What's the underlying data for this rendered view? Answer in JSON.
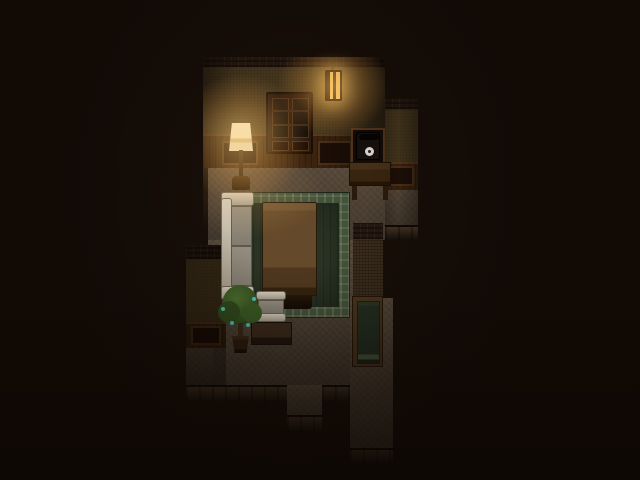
{
  "meta": {
    "type": "game-screenshot",
    "style": "top-down pixel RPG interior at night",
    "viewport": {
      "width": 640,
      "height": 480
    }
  },
  "scene": {
    "description": "Dark wooden apartment seen from above: upper room with a lit hanging wall lantern, glass-front cabinet, lit floor lamp and a telephone shelf above a small table; living area with a green patterned rug, a large wooden table, a pale sofa and armchair, a low dark table and a potted plant with teal blossoms; floor exits lead downward and a tall green-paneled door stands in the right-hand corridor",
    "objects": {
      "lantern": {
        "label": "Lit hanging wall lantern"
      },
      "cabinet": {
        "label": "Glass-front wooden cabinet"
      },
      "lamp": {
        "label": "Lit floor lamp"
      },
      "telephone": {
        "label": "Old telephone on wall shelf"
      },
      "phoneTable": {
        "label": "Small wooden side table"
      },
      "rug": {
        "label": "Green patterned rug"
      },
      "table": {
        "label": "Large wooden table"
      },
      "sofa": {
        "label": "Pale upholstered sofa"
      },
      "armchair": {
        "label": "Pale upholstered armchair"
      },
      "lowTable": {
        "label": "Low dark table"
      },
      "plant": {
        "label": "Potted plant with teal blossoms"
      },
      "door": {
        "label": "Tall green-paneled door"
      }
    }
  },
  "colors": {
    "outside": "#170e08",
    "wall-cap": "#251810",
    "wall-face": "#47381f",
    "wainscot": "#3a2410",
    "wainscot-frame": "#503218",
    "panel-dark": "#1e0f07",
    "floor": "#55483a",
    "cliff": "#2f2217",
    "rug-border": "#44513b",
    "rug-field": "#2b3525",
    "table-top": "#64492a",
    "sofa-frame": "#d3ccbd",
    "sofa-cushion": "#837d71",
    "plant-leaf": "#3c5a24",
    "plant-teal": "#4cc4b6",
    "pot": "#2b1b10",
    "door-frame": "#4b341d",
    "door-panel": "#232f21",
    "door-sill": "#47573e",
    "phone": "#15100b",
    "dial": "#d9d5cb",
    "shade": "#efe8d6",
    "glow": "#ffc76a"
  }
}
